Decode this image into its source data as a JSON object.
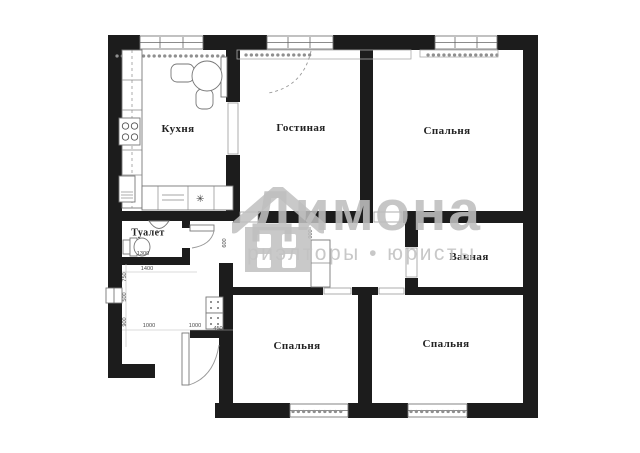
{
  "plan": {
    "rooms": [
      {
        "id": "kitchen",
        "label": "Кухня"
      },
      {
        "id": "living-room",
        "label": "Гостиная"
      },
      {
        "id": "bedroom-top-right",
        "label": "Спальня"
      },
      {
        "id": "bathroom",
        "label": "Ванная"
      },
      {
        "id": "toilet",
        "label": "Туалет"
      },
      {
        "id": "bedroom-bottom-center",
        "label": "Спальня"
      },
      {
        "id": "bedroom-bottom-right",
        "label": "Спальня"
      }
    ],
    "dimensions": [
      {
        "value": "1300"
      },
      {
        "value": "1400"
      },
      {
        "value": "750"
      },
      {
        "value": "500"
      },
      {
        "value": "900"
      },
      {
        "value": "1000"
      },
      {
        "value": "1000"
      },
      {
        "value": "450"
      },
      {
        "value": "600"
      },
      {
        "value": "900"
      }
    ],
    "icons": {
      "fan": "✳"
    }
  },
  "watermark": {
    "brand": "Димона",
    "tagline": "риэлторы • юристы",
    "color": "#c3c3c3"
  },
  "colors": {
    "wall": "#1c1c1c",
    "background": "#ffffff",
    "lines": "#8f8f8f"
  }
}
